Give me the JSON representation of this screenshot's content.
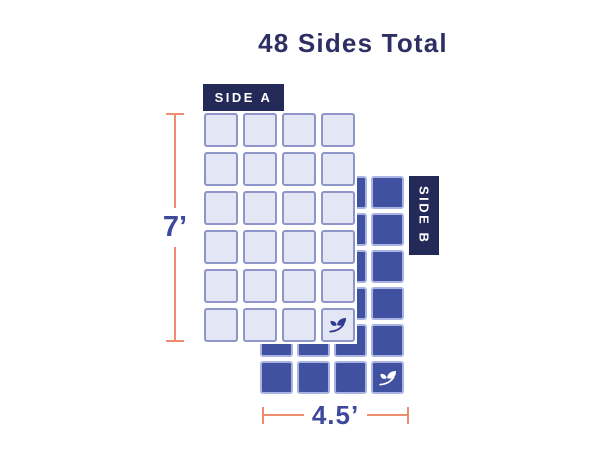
{
  "title": "48 Sides Total",
  "colors": {
    "background": "#ffffff",
    "title_text": "#2d2e63",
    "dimension_line": "#ed8d6d",
    "dimension_text": "#3e489c",
    "label_bg": "#242a58",
    "label_text": "#ffffff",
    "side_a_fill": "#e3e6f4",
    "side_a_border": "#8d95c9",
    "side_b_fill": "#3f51a0",
    "side_b_border": "#a9b4e3",
    "leaf_on_light": "#2e3a8e",
    "leaf_on_dark": "#ffffff"
  },
  "side_a": {
    "label": "SIDE A",
    "rows": 6,
    "columns": 4,
    "leaf_in_last_cell": true,
    "leaf_icon": "leaf-icon"
  },
  "side_b": {
    "label": "SIDE B",
    "rows": 6,
    "columns": 4,
    "leaf_in_last_cell": true,
    "leaf_icon": "leaf-icon"
  },
  "dimensions": {
    "height_label": "7’",
    "width_label": "4.5’"
  }
}
